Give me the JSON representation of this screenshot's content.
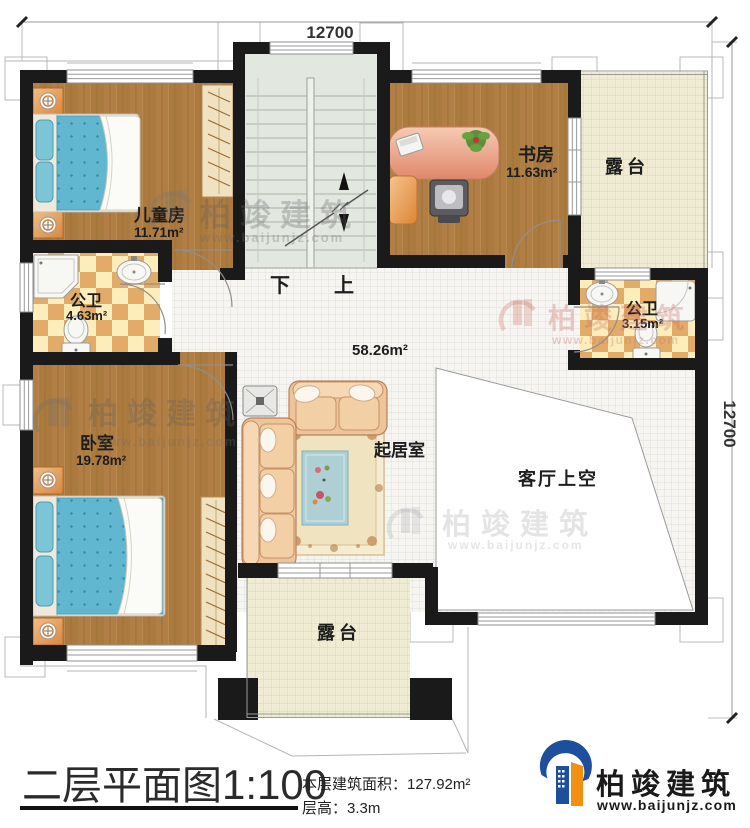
{
  "dimensions": {
    "top": "12700",
    "right": "12700"
  },
  "rooms": {
    "children": {
      "name": "儿童房",
      "area": "11.71m²"
    },
    "study": {
      "name": "书房",
      "area": "11.63m²"
    },
    "terrace_top": {
      "name": "露台"
    },
    "bath_left": {
      "name": "公卫",
      "area": "4.63m²"
    },
    "bath_right": {
      "name": "公卫",
      "area": "3.15m²"
    },
    "bedroom": {
      "name": "卧室",
      "area": "19.78m²"
    },
    "living": {
      "name": "起居室",
      "area": "58.26m²"
    },
    "void": {
      "name": "客厅上空"
    },
    "terrace_bottom": {
      "name": "露台"
    }
  },
  "stairs": {
    "down": "下",
    "up": "上"
  },
  "title": {
    "plan": "二层平面图",
    "scale": "1:100",
    "area_label": "本层建筑面积：",
    "area_value": "127.92m²",
    "floor_height_label": "层高：",
    "floor_height_value": "3.3m"
  },
  "brand": {
    "name": "柏竣建筑",
    "url": "www.baijunjz.com"
  },
  "watermark": {
    "name": "柏竣建筑",
    "url": "www.baijunjz.com"
  },
  "colors": {
    "wall": "#1a1a1a",
    "wood": "#ab7a3e",
    "tile": "#f6f5f2",
    "terrace": "#f0ecd3",
    "checker_cream": "#fbeebc",
    "checker_tan": "#e2ab67",
    "stair": "#e2e8e0",
    "mattress": "#62b7d0",
    "sofa": "#eec49b",
    "desk": "#e89a7e",
    "logo_blue": "#1d4f9c",
    "logo_orange": "#f29111"
  }
}
